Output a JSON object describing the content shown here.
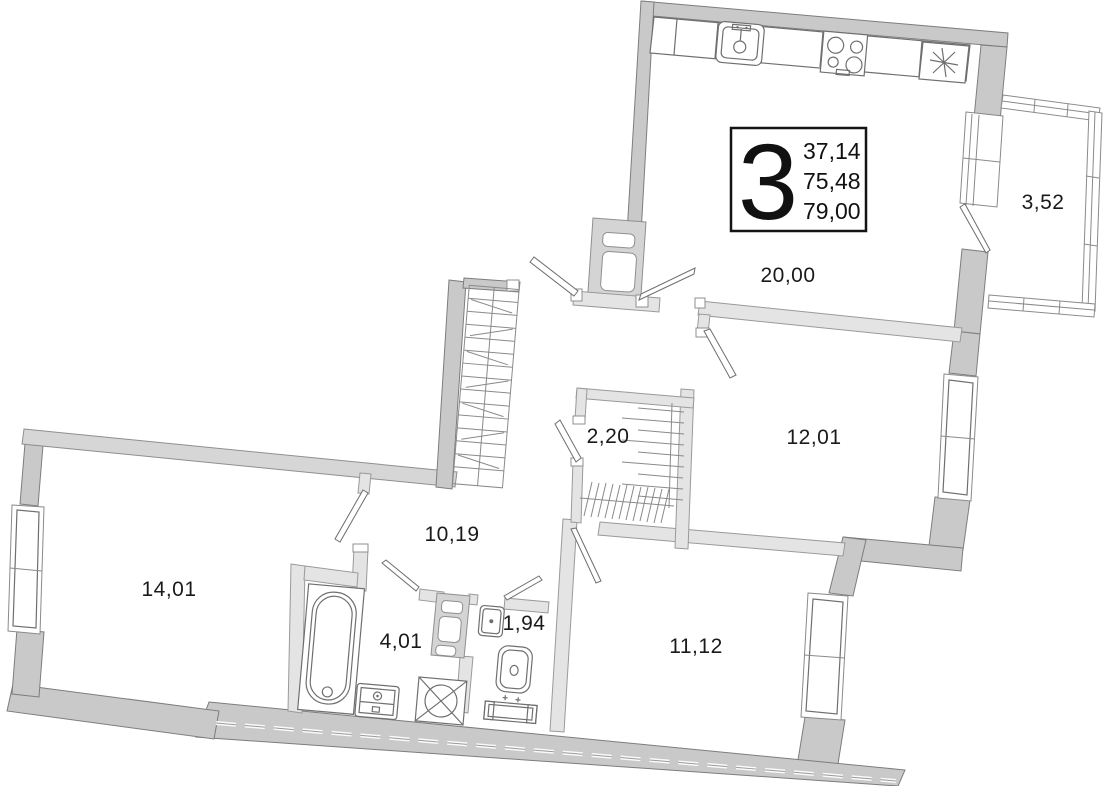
{
  "apartment": {
    "rooms_count": "3",
    "living_area": "37,14",
    "area": "75,48",
    "total_area": "79,00"
  },
  "rooms": [
    {
      "id": "kitchen-living",
      "area": "20,00"
    },
    {
      "id": "balcony",
      "area": "3,52"
    },
    {
      "id": "bedroom-right",
      "area": "12,01"
    },
    {
      "id": "closet",
      "area": "2,20"
    },
    {
      "id": "hallway",
      "area": "10,19"
    },
    {
      "id": "bedroom-left",
      "area": "14,01"
    },
    {
      "id": "bathroom",
      "area": "4,01"
    },
    {
      "id": "wc",
      "area": "1,94"
    },
    {
      "id": "bedroom-bottom",
      "area": "11,12"
    }
  ],
  "colors": {
    "outer_wall": "#c9c9c9",
    "inner_wall": "#e4e4e4",
    "line": "#6f6f6f",
    "text": "#1a1a1a"
  }
}
